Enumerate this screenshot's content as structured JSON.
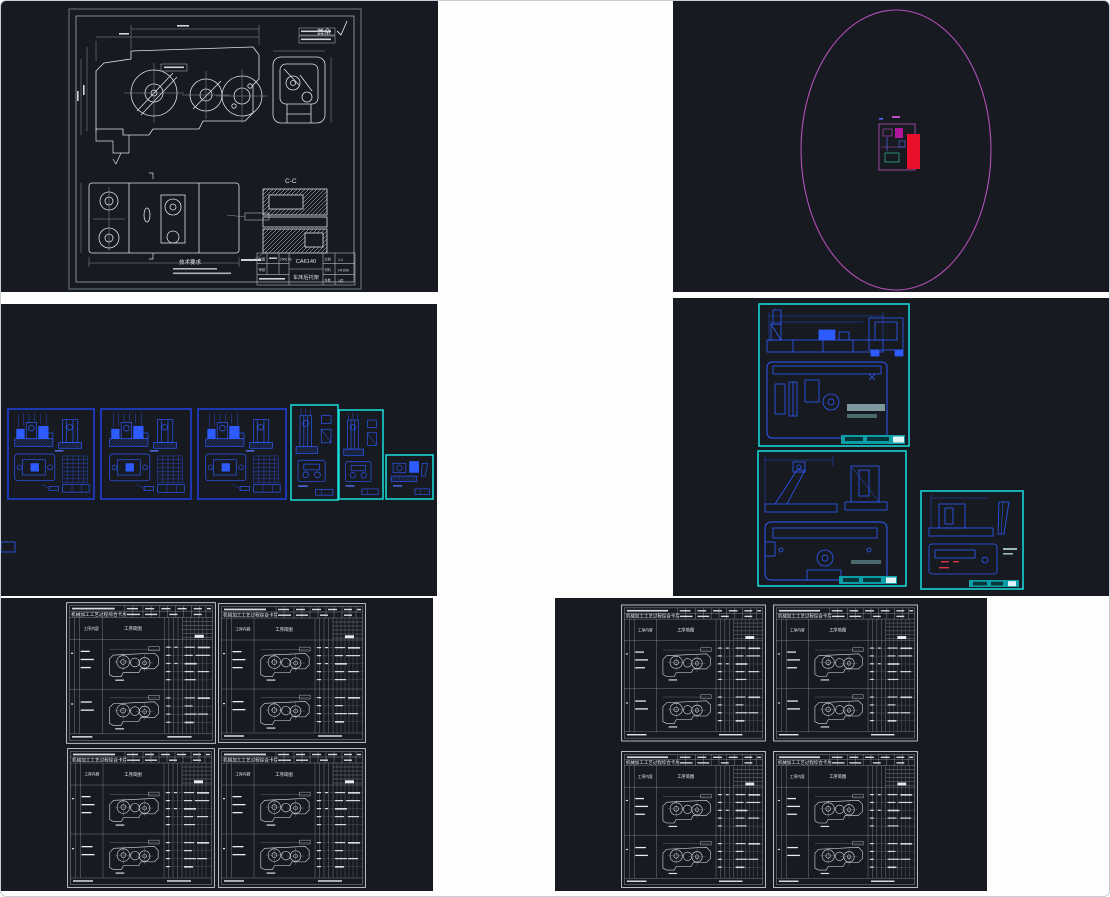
{
  "colors": {
    "panel_background": "#171a20",
    "white_line": "#dde1e6",
    "blue_line": "#2e5bff",
    "blue_sheet_border": "#1f3fd9",
    "cyan_sheet_border": "#17e0e0",
    "magenta_ellipse": "#b44fb8",
    "red_fill": "#e8102a",
    "teal_titleblock_fill": "#0c9ea6",
    "card_line": "#c2c8d0"
  },
  "part_drawing": {
    "surface_note": "其余",
    "section_label": "C-C",
    "tech_title": "技术要求",
    "title_block": {
      "part_code": "CA6140",
      "part_name": "车床后托架",
      "draw_label": "制图",
      "check_label": "审核",
      "date": "2006.06",
      "scale_label": "比例",
      "scale": "1:1",
      "material_label": "材料",
      "material": "HT200",
      "qty_label": "件数",
      "qty": "1件"
    }
  },
  "process_card": {
    "title": "机械加工工艺过程综合卡片",
    "content_col": "工序内容",
    "sketch_col": "工序简图"
  }
}
